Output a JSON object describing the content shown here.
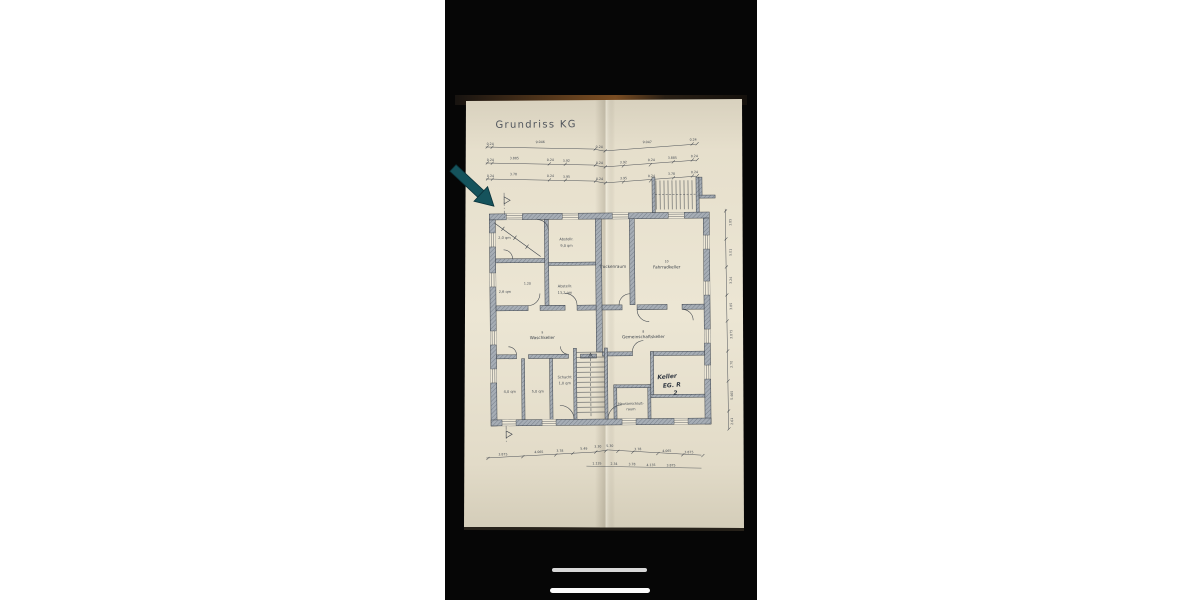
{
  "photo": {
    "title": "Grundriss KG",
    "labels": {
      "trockenraum": "Trockenraum",
      "fahrradkeller": "Fahrradkeller",
      "fahrradkeller_no": "10",
      "waschkeller": "Waschkeller",
      "waschkeller_no": "9",
      "gemeinschaftskeller": "Gemeinschaftskeller",
      "gemeinschaftskeller_no": "8",
      "hausanschluss_1": "Hausanschluß-",
      "hausanschluss_2": "raum",
      "keller_hw_1": "Keller",
      "keller_hw_2": "EG. R",
      "keller_hw_3": "2",
      "room_a": "2,0 qm",
      "room_b": "2,6 qm",
      "abstell_1a": "Abstellr.",
      "abstell_1b": "9,0 qm",
      "abstell_2a": "Abstellr.",
      "abstell_2b": "13,2 qm",
      "inner_dim": "1.20",
      "cell_1": "4,0 qm",
      "cell_2": "5,0 qm",
      "cell_3a": "Schacht",
      "cell_3b": "1,0 qm"
    },
    "dims": {
      "top1": [
        "0.24",
        "9.046",
        "0.24",
        "9.047",
        "0.24"
      ],
      "top2": [
        "0.24",
        "3.885",
        "0.24",
        "3.92",
        "0.24",
        "3.92",
        "0.24",
        "3.885",
        "0.24"
      ],
      "top3": [
        "0.24",
        "3.78",
        "0.24",
        "3.95",
        "0.24",
        "3.95",
        "0.24",
        "3.78",
        "0.24"
      ],
      "bottom1": [
        "3.875",
        "4.065",
        "3.78",
        "5.49",
        "3.30",
        "5.30",
        "3.78",
        "4.065",
        "3.875"
      ],
      "bottom2": [
        "1.135",
        "2.34",
        "3.78",
        "4.135",
        "3.875"
      ],
      "right": [
        "1.85",
        "5.01",
        "3.24",
        "3.85",
        "3.875",
        "2.70",
        "5.465",
        "2.61"
      ]
    },
    "colors": {
      "paper": "#e9e2d0",
      "ink": "#3d434b",
      "wall": "#9aa2ab",
      "arrow": "#15535c",
      "photo_background": "#060606"
    }
  }
}
